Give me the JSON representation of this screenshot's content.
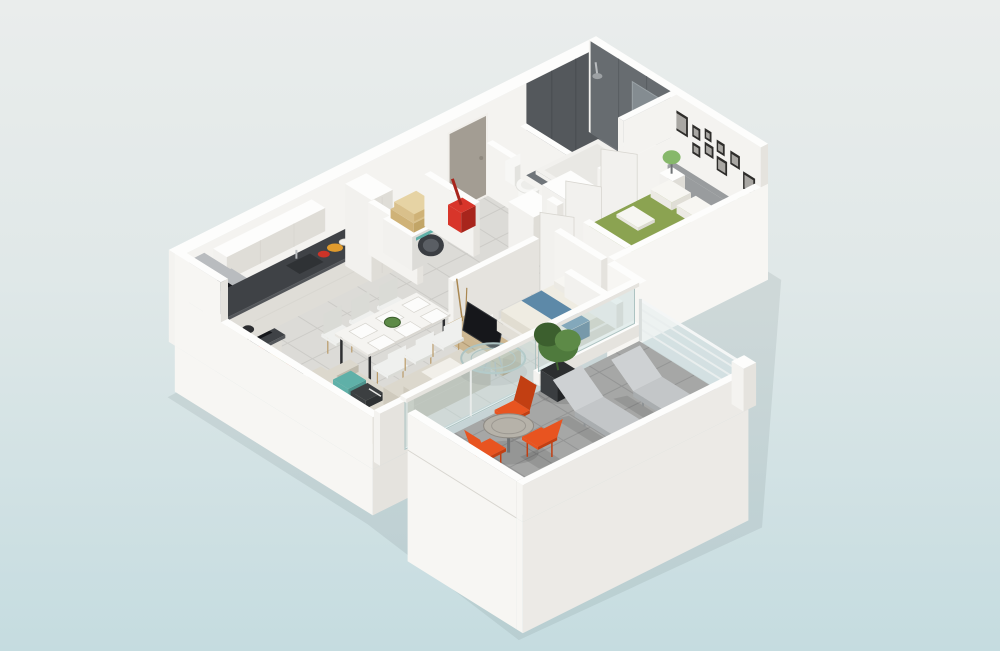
{
  "scene": {
    "type": "3d-floor-plan-render",
    "view": "isometric-cutaway-dollhouse",
    "background": {
      "top": "#eaedec",
      "mid": "#e0e8e8",
      "bottom": "#c5dce0"
    },
    "palette": {
      "bg_top": "#eaedec",
      "bg_mid": "#e0e8e8",
      "bg_bottom": "#c5dce0",
      "floor": "#dcdbd7",
      "floor_grout": "#cccbc7",
      "terrace_floor": "#a6a7a6",
      "terrace_grout": "#949595",
      "wall_top": "#fdfdfc",
      "wall_light": "#f4f3f0",
      "wall_mid": "#e5e3de",
      "wall_dark": "#d8d6d0",
      "facade": "#f7f6f3",
      "facade_shade": "#eceae6",
      "dark_tile": "#54585c",
      "dark_tile2": "#676c70",
      "bath_floor": "#70757a",
      "mirror": "#848c91",
      "wood": "#c8a26a",
      "wood_dark": "#a98751",
      "counter": "#3f4246",
      "counter_side": "#54575b",
      "sink": "#2f3235",
      "black": "#16171b",
      "steel": "#b9bcbf",
      "steel_dark": "#9da1a4",
      "hob_red": "#e8392e",
      "washer_door": "#3a3d42",
      "washer_door_inner": "#5a5e64",
      "towel": "#d9c08b",
      "towel_light": "#e6d3a4",
      "vacuum": "#d8352a",
      "vacuum_dark": "#a8251c",
      "white_obj": "#f2f1ee",
      "white_obj_shade": "#dfddd7",
      "sofa_top": "#dcd8cd",
      "sofa_side": "#cfcabd",
      "sofa_dark": "#bfbaac",
      "teal": "#5fb0a8",
      "pattern_dark": "#3c3f41",
      "table_top": "#f5f4f1",
      "leg_dark": "#2e2f31",
      "leg_wood": "#b99a68",
      "chair_white": "#eff0ee",
      "chair_shade": "#dadbd6",
      "glass": "rgba(190,215,215,0.40)",
      "glass_edge": "#adc3c2",
      "bed_green": "#8ba351",
      "bed_green_side": "#7d9347",
      "bed_green_dark": "#70853d",
      "headboard": "#999c9e",
      "headboard_dark": "#87898c",
      "pillow": "#f7f6f2",
      "duvet": "#efece2",
      "duvet_side": "#e1ddd1",
      "duvet_dark": "#d6d2c4",
      "blue": "#5d89a8",
      "blue_dark": "#49708c",
      "tv_wood": "#cdb791",
      "tv_wood_dark": "#b29a73",
      "plant": "#4f7a3d",
      "plant_dark": "#3c5f2e",
      "plant_light": "#5d8a47",
      "pot": "#2c2e30",
      "orange": "#e85420",
      "orange_dark": "#c23f12",
      "lounger": "#c3c6c8",
      "lounger_light": "#ced1d3",
      "lounger_dark": "#a9adaf",
      "lounger_frame": "#8e9294",
      "rail": "#e9eeee",
      "rail_post": "#d9dedd",
      "rail_glass": "rgba(225,238,240,0.45)",
      "lamp_green": "#86b86a",
      "lamp_stem": "#6f7375",
      "toilet": "#f7f7f5",
      "toilet_shade": "#e3e3df",
      "door": "#a39d93",
      "door_dark": "#8f897f",
      "frame_dark": "#2e2d2b",
      "photo": "#a9a7a3",
      "fruit_orange": "#e09b2d",
      "fruit_red": "#cc3327",
      "shadow": "rgba(90,105,110,0.12)"
    },
    "rooms": [
      {
        "name": "kitchen",
        "furniture": [
          "l-shaped-counter",
          "dark-worktop",
          "induction-hob",
          "extractor-hood",
          "sink",
          "upper-cabinets",
          "tall-steel-oven-unit",
          "fridge-column",
          "fruit-bowls"
        ]
      },
      {
        "name": "utility-closet",
        "furniture": [
          "washing-machine",
          "folded-towels",
          "red-vacuum-cleaner"
        ]
      },
      {
        "name": "dining-area",
        "furniture": [
          "white-dining-table",
          "six-white-chairs",
          "green-centerpiece",
          "place-settings"
        ]
      },
      {
        "name": "living-area",
        "furniture": [
          "corner-sofa",
          "teal-cushion",
          "patterned-cushion",
          "round-glass-coffee-table",
          "low-sideboard-with-books",
          "black-floor-lamp",
          "tv-cabinet",
          "flat-screen-tv",
          "decor-branches"
        ]
      },
      {
        "name": "hallway",
        "furniture": [
          "entrance-door",
          "wardrobe-closets",
          "open-door-leaves"
        ]
      },
      {
        "name": "wc",
        "furniture": [
          "toilet"
        ]
      },
      {
        "name": "bathroom",
        "furniture": [
          "walk-in-shower",
          "dark-gray-wall-tiles",
          "white-shower-tray",
          "shower-head",
          "wall-mirror",
          "white-washbasin",
          "wood-vanity"
        ]
      },
      {
        "name": "master-bedroom",
        "furniture": [
          "double-bed-green-cover",
          "gray-headboard",
          "white-pillows",
          "folded-white-towels",
          "two-nightstands",
          "green-table-lamps",
          "gallery-picture-frames",
          "white-bench"
        ]
      },
      {
        "name": "second-bedroom",
        "furniture": [
          "double-bed-white-duvet",
          "blue-bed-runner",
          "white-pillows",
          "low-headboard"
        ]
      },
      {
        "name": "terrace",
        "furniture": [
          "round-bistro-table",
          "three-orange-chairs",
          "two-gray-sun-loungers",
          "black-potted-plant",
          "glass-cable-railing",
          "white-parapet-walls",
          "sliding-glass-door",
          "corner-window"
        ]
      }
    ]
  }
}
